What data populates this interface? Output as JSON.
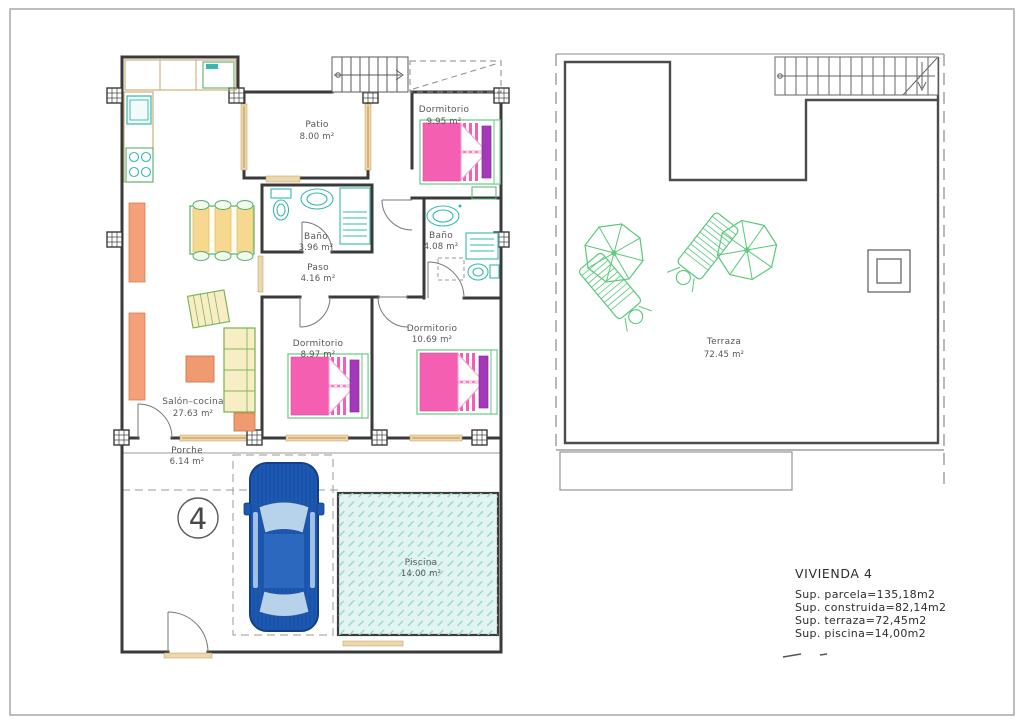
{
  "colors": {
    "wall": "#3a3a3a",
    "bed_pink": "#f55fb1",
    "pillow_purple": "#a338b8",
    "fixture_teal": "#35b9ae",
    "furniture_orange": "#f09a70",
    "furniture_yellow": "#f6d98e",
    "outline_green": "#58c87a",
    "car_blue": "#1d59b0",
    "pool_fill": "#e2f4f1",
    "window_tan": "#ecd9ab"
  },
  "floor_plan": {
    "unit_number": "4",
    "rooms": [
      {
        "name": "Patio",
        "area": "8.00 m²"
      },
      {
        "name": "Dormitorio",
        "area": "9.95 m²"
      },
      {
        "name": "Baño",
        "area": "3.96 m²"
      },
      {
        "name": "Baño",
        "area": "4.08 m²"
      },
      {
        "name": "Paso",
        "area": "4.16 m²"
      },
      {
        "name": "Dormitorio",
        "area": "8.97 m²"
      },
      {
        "name": "Dormitorio",
        "area": "10.69 m²"
      },
      {
        "name": "Salón–cocina",
        "area": "27.63 m²"
      },
      {
        "name": "Porche",
        "area": "6.14 m²"
      },
      {
        "name": "Piscina",
        "area": "14.00 m²"
      }
    ]
  },
  "terrace_plan": {
    "room": {
      "name": "Terraza",
      "area": "72.45 m²"
    }
  },
  "summary": {
    "title": "VIVIENDA  4",
    "lines": [
      "Sup.  parcela=135,18m2",
      "Sup.  construida=82,14m2",
      "Sup.  terraza=72,45m2",
      "Sup.  piscina=14,00m2"
    ]
  }
}
